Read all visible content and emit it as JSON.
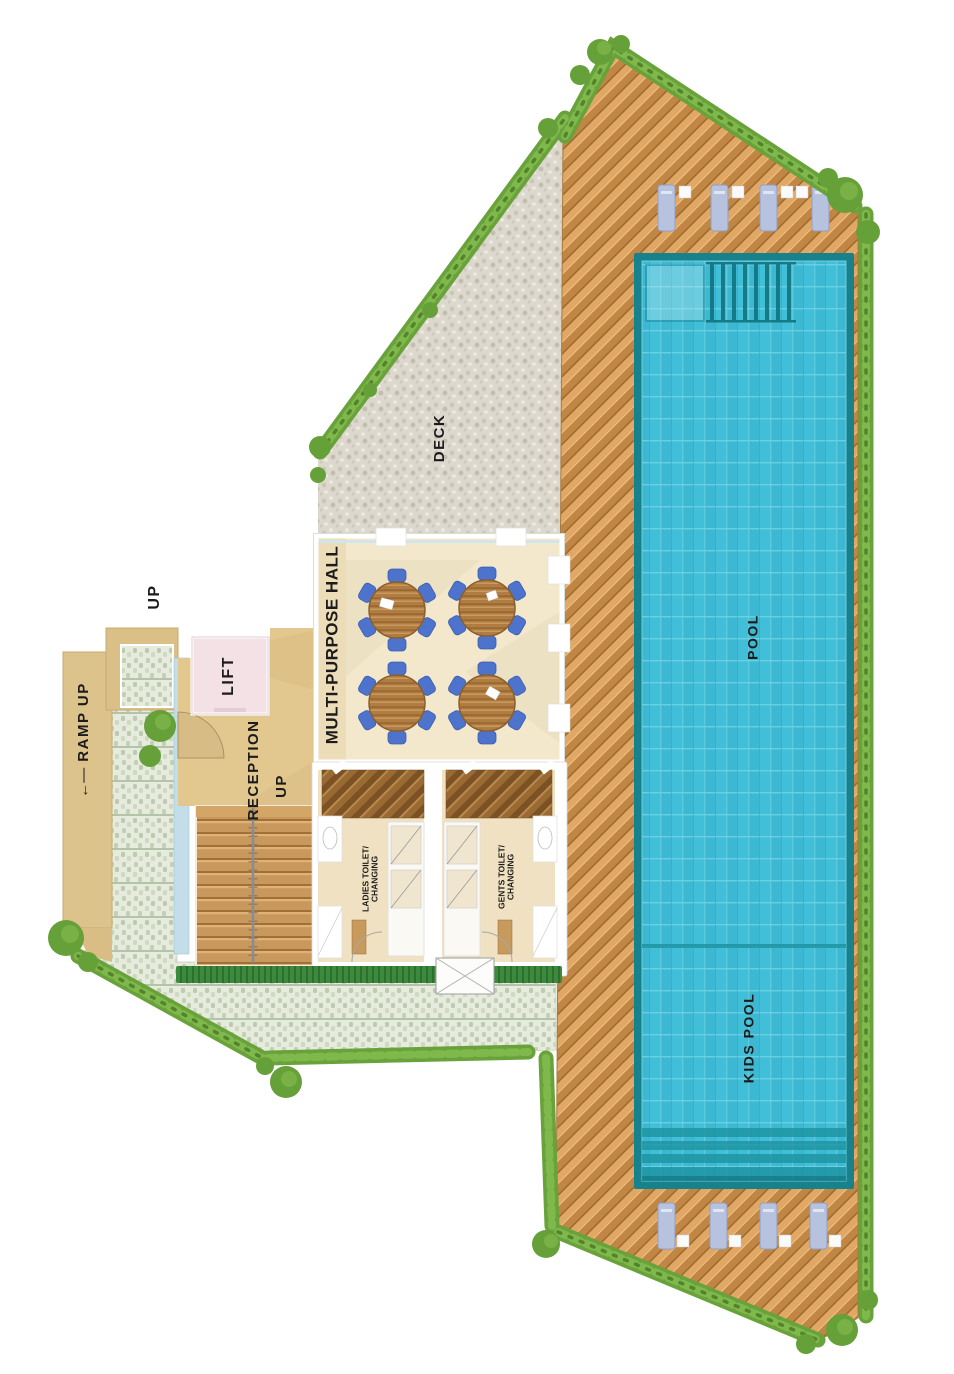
{
  "plan": {
    "type": "pool-amenity-floor-plan",
    "background": "#ffffff",
    "labels": {
      "up_top": "UP",
      "ramp_arrow": "←—",
      "ramp_up": "RAMP UP",
      "lift": "LIFT",
      "reception": "RECEPTION",
      "up_inner": "UP",
      "multi_purpose_hall": "MULTI-PURPOSE HALL",
      "deck": "DECK",
      "pool": "POOL",
      "kids_pool": "KIDS POOL",
      "ladies_toilet": {
        "line1": "LADIES TOILET/",
        "line2": "CHANGING"
      },
      "gents_toilet": {
        "line1": "GENTS TOILET/",
        "line2": "CHANGING"
      }
    },
    "colors": {
      "pool_water": "#41bed8",
      "pool_edge": "#17828c",
      "deck_wood_light": "#e0a765",
      "deck_wood_dark": "#c18544",
      "gravel": "#dcd8cd",
      "paver": "#e7ebdd",
      "paver_dot": "#bccbaf",
      "hedge_green": "#69a23b",
      "hall_floor": "#f4e8cc",
      "reception_floor": "#e2c78f",
      "stair_wood": "#c9985c",
      "lift_pink": "#f3e1e6",
      "lounger_blue": "#b7c2df",
      "chair_blue": "#4e73cc",
      "table_wood": "#b07c42",
      "label_text": "#1b1b1b"
    },
    "features": {
      "hall_round_tables": 4,
      "chairs_per_table": 6,
      "sun_loungers_top": 4,
      "sun_loungers_bottom": 4,
      "pool_sections": [
        "POOL",
        "KIDS POOL"
      ]
    }
  }
}
